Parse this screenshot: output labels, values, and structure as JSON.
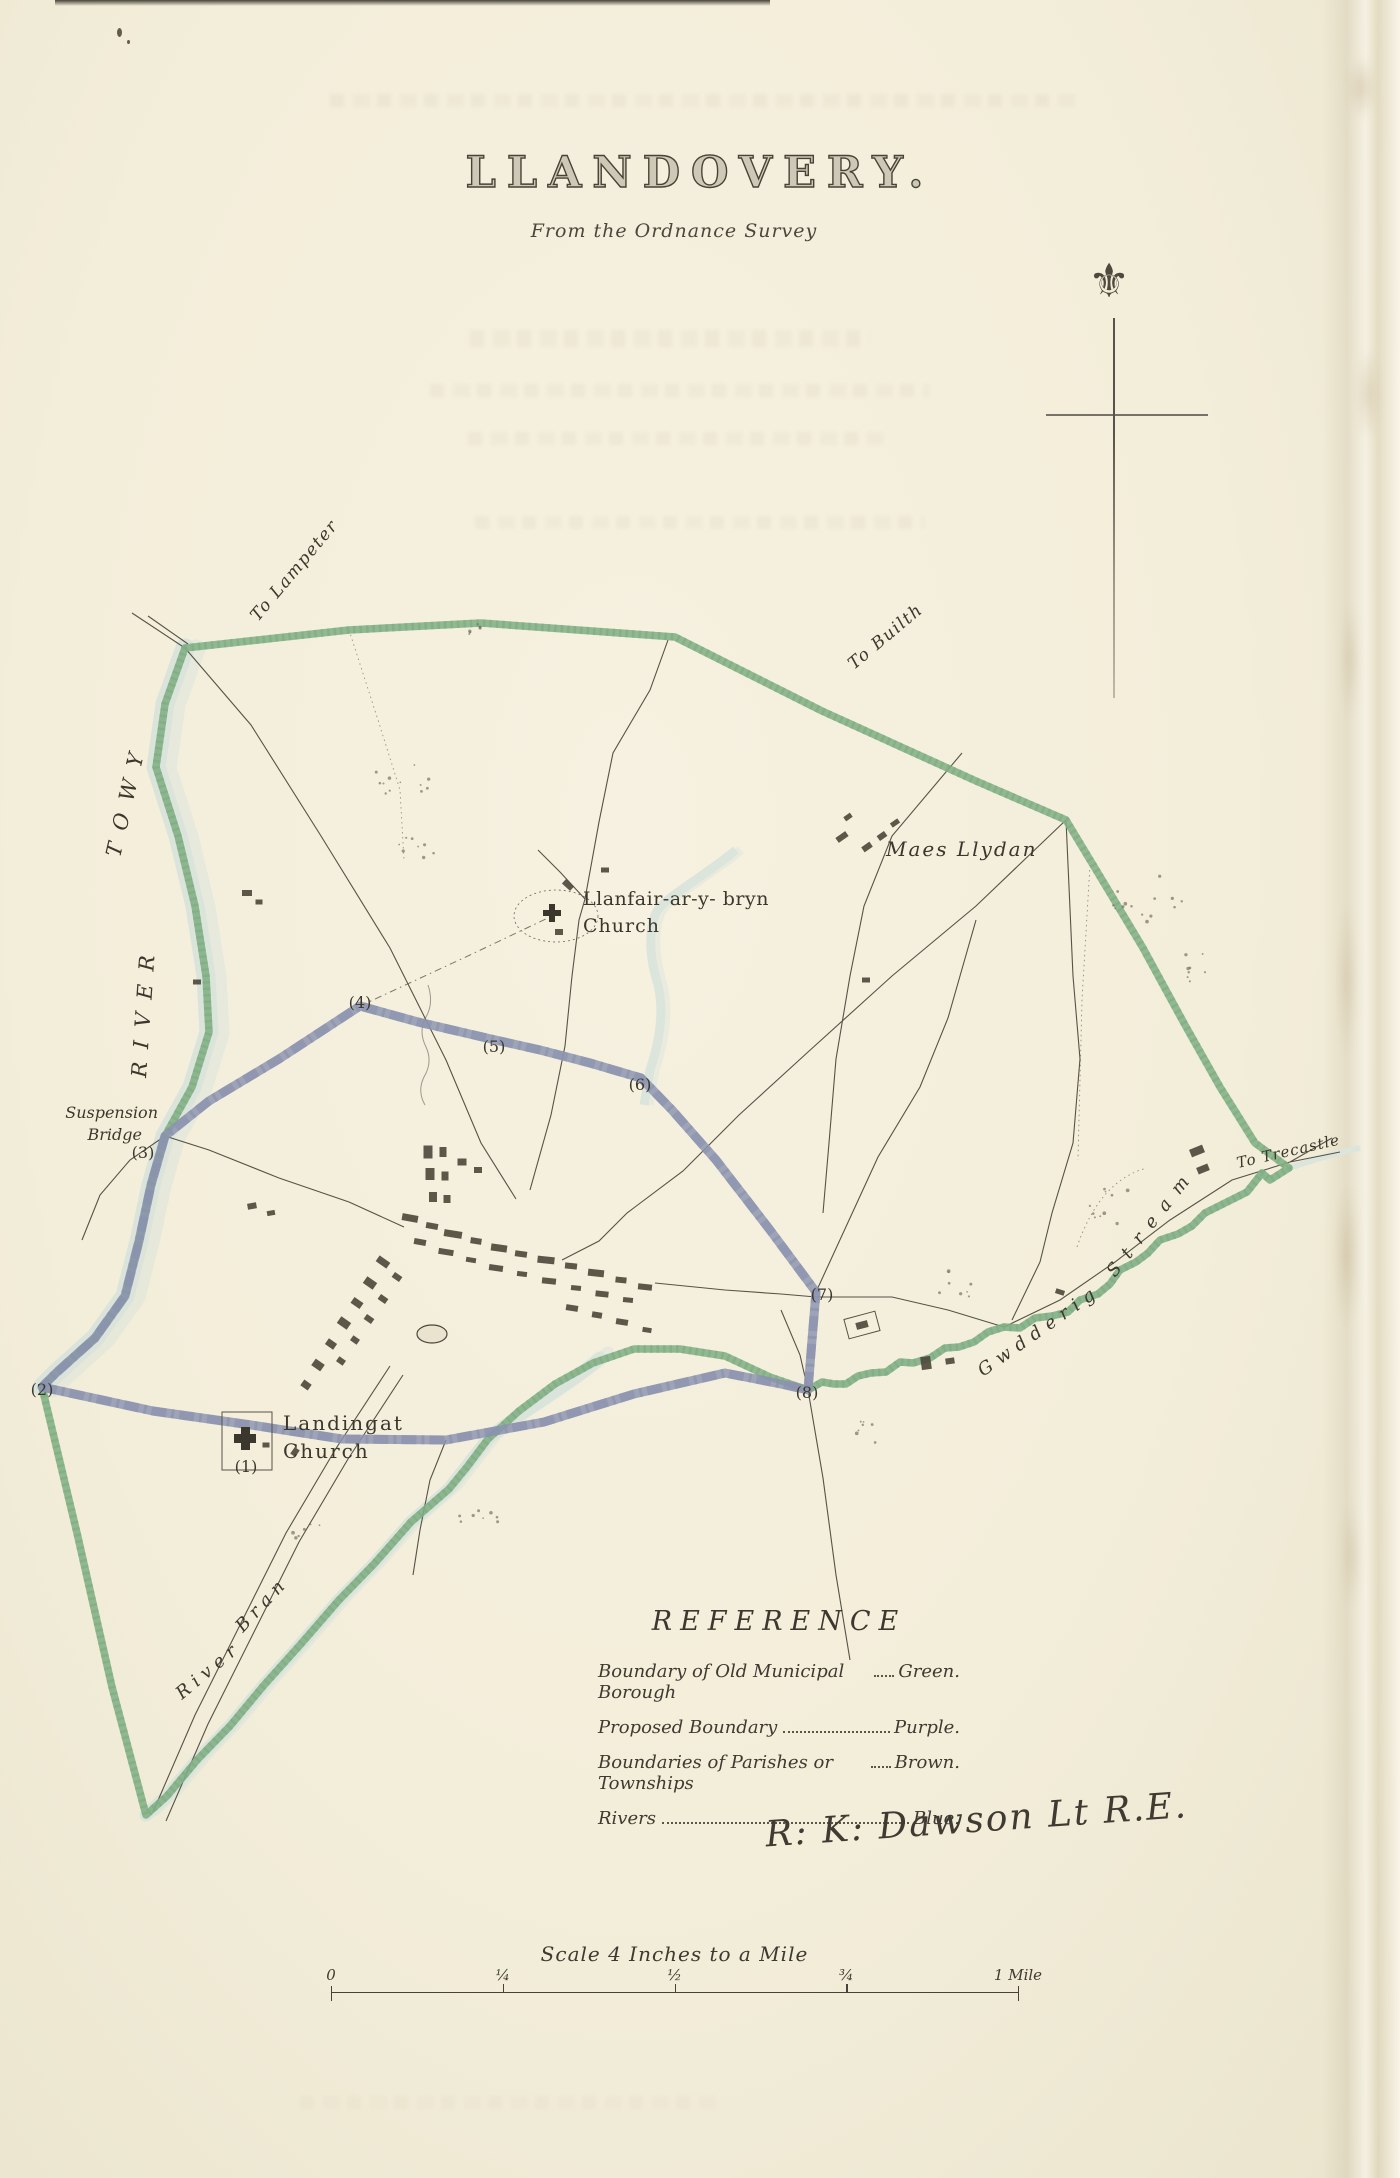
{
  "page": {
    "title": "LLANDOVERY.",
    "subtitle": "From the Ordnance Survey"
  },
  "icons": {
    "compass_fleur": "⚜"
  },
  "map": {
    "labels": {
      "to_lampeter": "To Lampeter",
      "to_builth": "To Builth",
      "to_trecastle": "To Trecastle",
      "maes_llydan": "Maes Llydan",
      "llanfair_line1": "Llanfair-ar-y- bryn",
      "llanfair_line2": "Church",
      "suspension_line1": "Suspension",
      "suspension_line2": "Bridge",
      "landingat_line1": "Landingat",
      "landingat_line2": "Church",
      "river_towy_word1": "RIVER",
      "river_towy_word2": "TOWY",
      "river_bran_word1": "River",
      "river_bran_word2": "Bran",
      "gwdderig_word1": "Gwdderig",
      "gwdderig_word2": "Stream"
    },
    "markers": [
      "(1)",
      "(2)",
      "(3)",
      "(4)",
      "(5)",
      "(6)",
      "(7)",
      "(8)"
    ]
  },
  "reference": {
    "title": "REFERENCE",
    "rows": [
      {
        "label": "Boundary of Old Municipal Borough",
        "value": "Green."
      },
      {
        "label": "Proposed Boundary",
        "value": "Purple."
      },
      {
        "label": "Boundaries of Parishes or Townships",
        "value": "Brown."
      },
      {
        "label": "Rivers",
        "value": "Blue."
      }
    ],
    "signature": "R: K: Dawson Lt R.E."
  },
  "scale_bar": {
    "title": "Scale 4 Inches to a Mile",
    "ticks": [
      "0",
      "¼",
      "½",
      "¾",
      "1 Mile"
    ]
  },
  "colors": {
    "boundary_green": "#7fae83",
    "boundary_purple": "#8b93af",
    "river_blue": "#d9e2da",
    "ink": "#46423a"
  }
}
